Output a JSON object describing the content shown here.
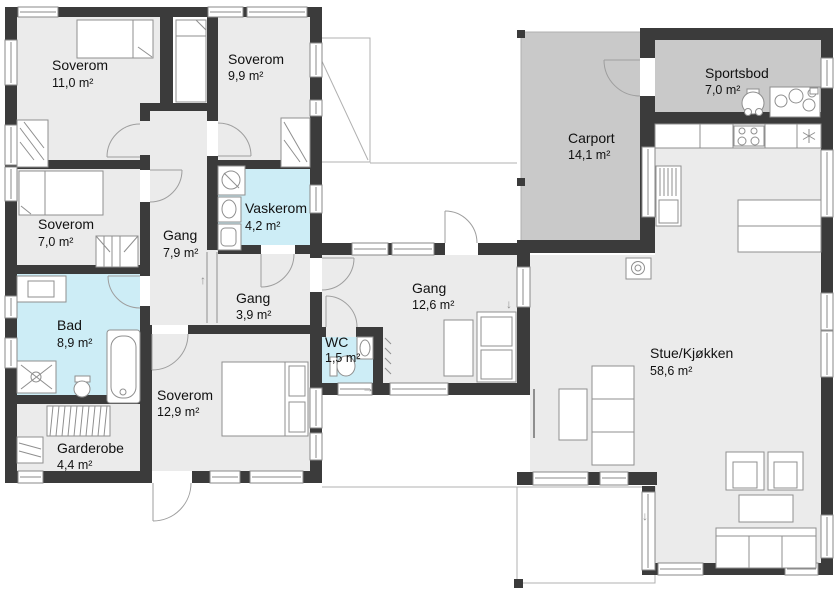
{
  "plan": {
    "unit_suffix": "m²",
    "rooms": [
      {
        "id": "soverom-11",
        "name": "Soverom",
        "area": "11,0 m²",
        "type": "room"
      },
      {
        "id": "soverom-99",
        "name": "Soverom",
        "area": "9,9 m²",
        "type": "room"
      },
      {
        "id": "soverom-70",
        "name": "Soverom",
        "area": "7,0 m²",
        "type": "room"
      },
      {
        "id": "gang-79",
        "name": "Gang",
        "area": "7,9 m²",
        "type": "room"
      },
      {
        "id": "vaskerom",
        "name": "Vaskerom",
        "area": "4,2 m²",
        "type": "wet"
      },
      {
        "id": "gang-39",
        "name": "Gang",
        "area": "3,9 m²",
        "type": "room"
      },
      {
        "id": "bad",
        "name": "Bad",
        "area": "8,9 m²",
        "type": "wet"
      },
      {
        "id": "wc",
        "name": "WC",
        "area": "1,5 m²",
        "type": "wet"
      },
      {
        "id": "soverom-129",
        "name": "Soverom",
        "area": "12,9 m²",
        "type": "room"
      },
      {
        "id": "garderobe",
        "name": "Garderobe",
        "area": "4,4 m²",
        "type": "room"
      },
      {
        "id": "gang-126",
        "name": "Gang",
        "area": "12,6 m²",
        "type": "room"
      },
      {
        "id": "carport",
        "name": "Carport",
        "area": "14,1 m²",
        "type": "garage"
      },
      {
        "id": "sportsbod",
        "name": "Sportsbod",
        "area": "7,0 m²",
        "type": "garage"
      },
      {
        "id": "stue",
        "name": "Stue/Kjøkken",
        "area": "58,6 m²",
        "type": "room"
      }
    ]
  },
  "colors": {
    "wall": "#3b3b3b",
    "floor": "#ebebeb",
    "wet_floor": "#cdedf6",
    "garage_floor": "#c9c9c9",
    "line": "#8f8f8f",
    "door": "#9e9e9e",
    "text": "#111111",
    "window_fill": "#ffffff",
    "terrace_line": "#b0b0b0"
  },
  "icons": {
    "arrow_up": "↑",
    "arrow_right": "→",
    "arrow_down": "↓",
    "freezer_star": "six-spoked asterisk (fridge/freezer symbol)"
  }
}
